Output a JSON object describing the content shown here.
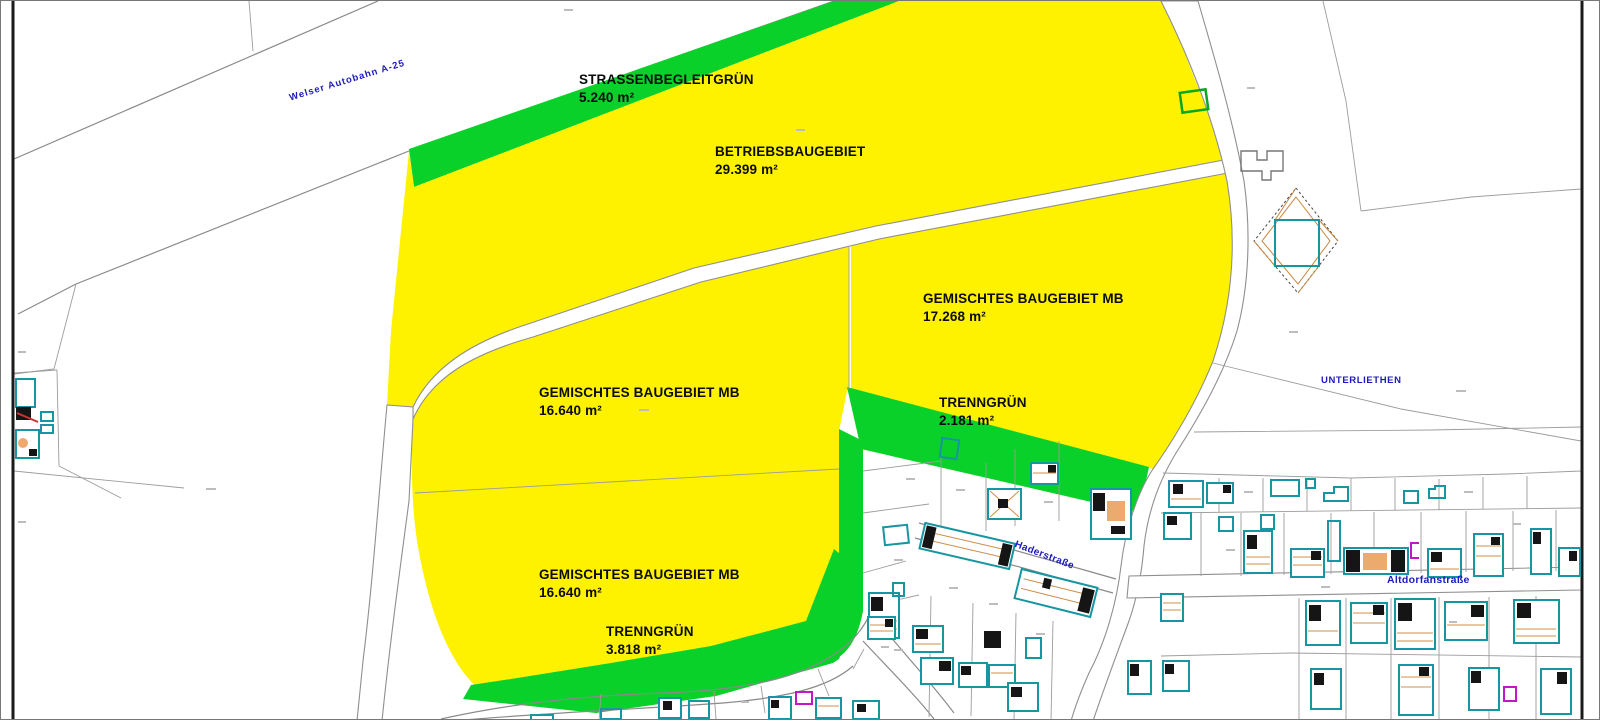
{
  "theme": {
    "zone-yellow": "#fff200",
    "zone-green": "#0ad02a",
    "label-blue": "#1c1abe",
    "cad-teal": "#1795a0",
    "cad-orange": "#edaa6e",
    "cad-magenta": "#c316c9"
  },
  "map": {
    "labels": {
      "strassenbegleitgruen": {
        "title": "STRASSENBEGLEITGRÜN",
        "area": "5.240 m²"
      },
      "betriebsbaugebiet": {
        "title": "BETRIEBSBAUGEBIET",
        "area": "29.399 m²"
      },
      "gemischtes_nord": {
        "title": "GEMISCHTES BAUGEBIET MB",
        "area": "17.268 m²"
      },
      "gemischtes_mitte": {
        "title": "GEMISCHTES BAUGEBIET MB",
        "area": "16.640 m²"
      },
      "trenngruen_ost": {
        "title": "TRENNGRÜN",
        "area": "2.181 m²"
      },
      "gemischtes_sued": {
        "title": "GEMISCHTES BAUGEBIET MB",
        "area": "16.640 m²"
      },
      "trenngruen_sued": {
        "title": "TRENNGRÜN",
        "area": "3.818 m²"
      },
      "autobahn": {
        "title": "Welser Autobahn  A-25"
      },
      "unterliethen": {
        "title": "UNTERLIETHEN"
      },
      "strasse_quer": {
        "title": "Haderstraße"
      },
      "strasse_ost": {
        "title": "Altdorfanstraße"
      }
    }
  }
}
